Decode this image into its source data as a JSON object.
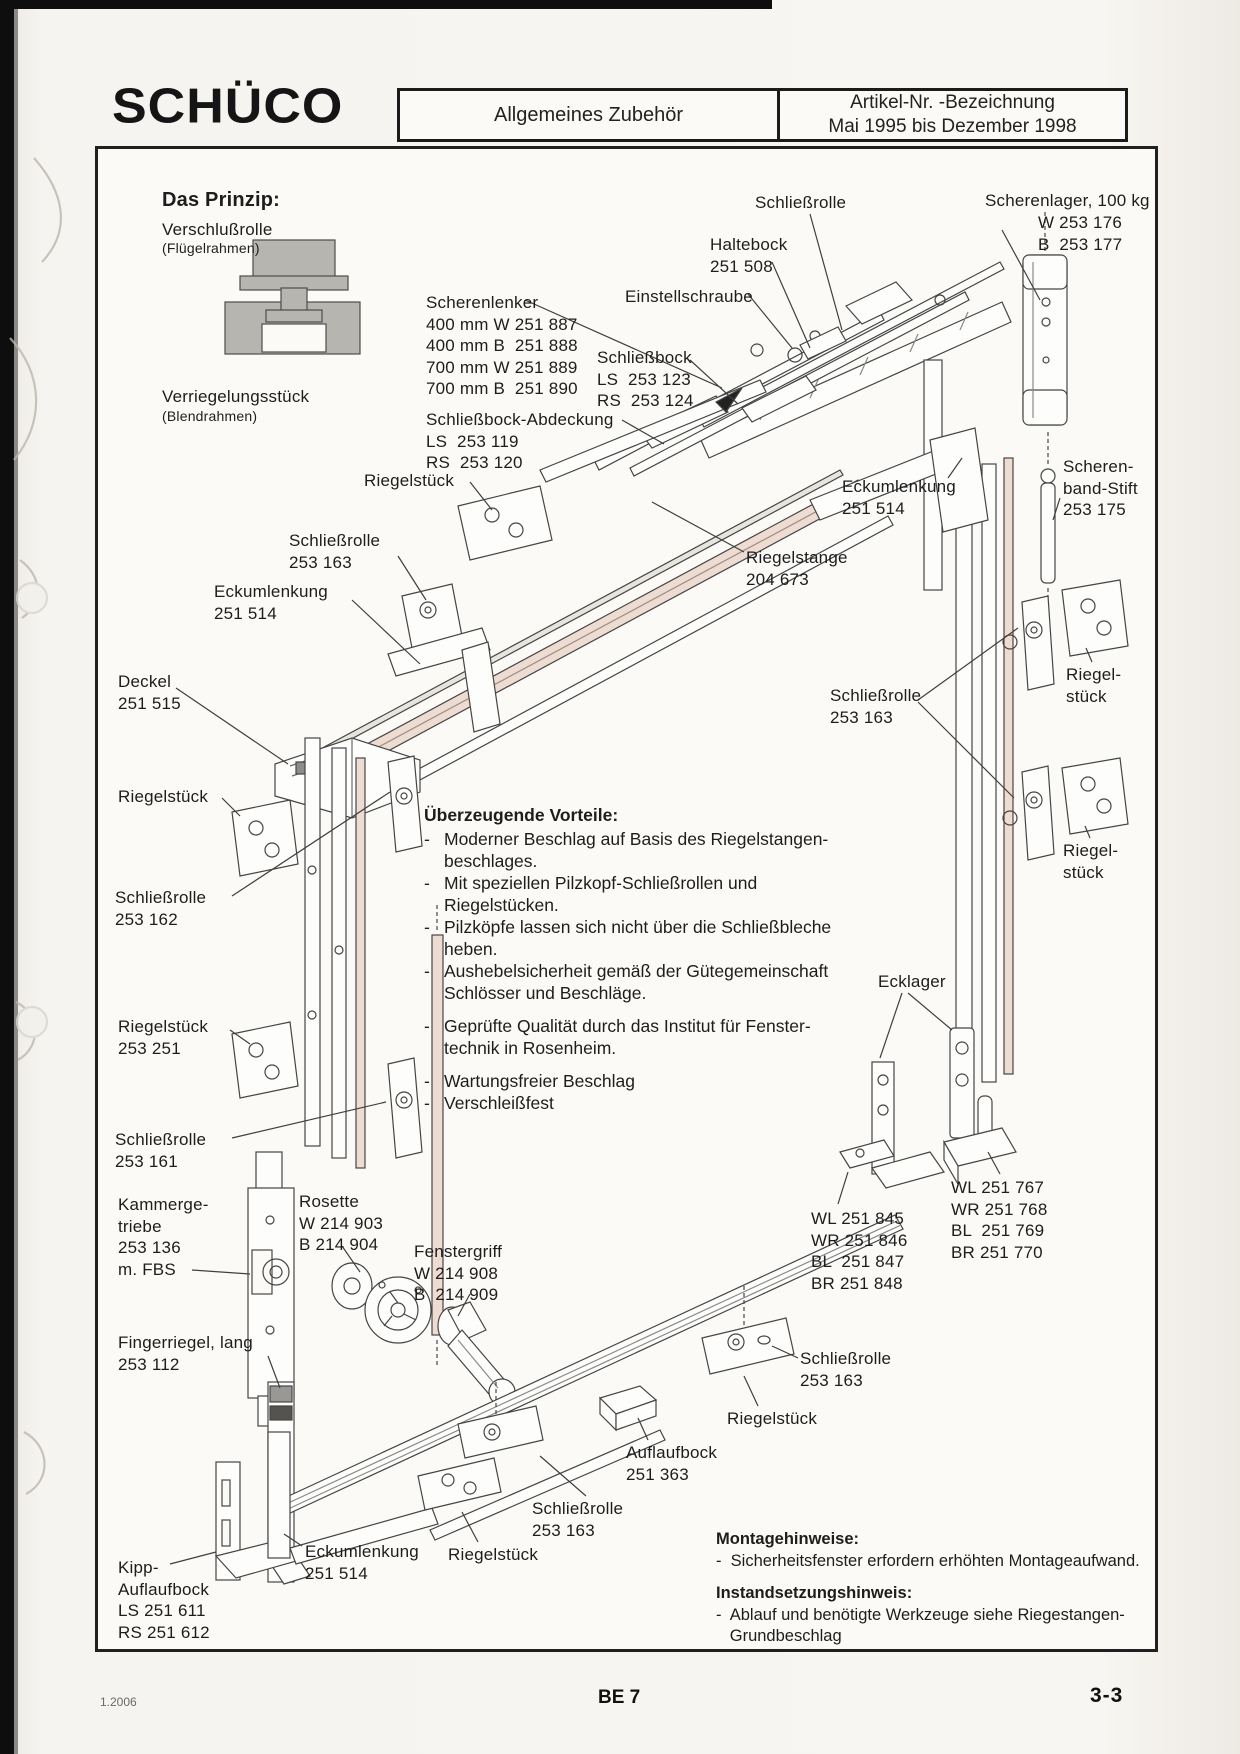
{
  "header": {
    "logo": "SCHÜCO",
    "section": "Allgemeines Zubehör",
    "right_line1": "Artikel-Nr. -Bezeichnung",
    "right_line2": "Mai 1995 bis Dezember 1998"
  },
  "advantages": {
    "title": "Überzeugende Vorteile:",
    "lines": [
      {
        "dash": true,
        "text": "Moderner Beschlag auf Basis des Riegelstangen-"
      },
      {
        "dash": false,
        "text": "beschlages."
      },
      {
        "dash": true,
        "text": "Mit speziellen Pilzkopf-Schließrollen und"
      },
      {
        "dash": false,
        "text": "Riegelstücken."
      },
      {
        "dash": true,
        "text": "Pilzköpfe lassen sich nicht über die Schließbleche"
      },
      {
        "dash": false,
        "text": "heben."
      },
      {
        "dash": true,
        "text": "Aushebelsicherheit gemäß der Gütegemeinschaft"
      },
      {
        "dash": false,
        "text": "Schlösser und Beschläge."
      },
      {
        "gap": true
      },
      {
        "dash": true,
        "text": "Geprüfte Qualität  durch das Institut für Fenster-"
      },
      {
        "dash": false,
        "text": "technik in Rosenheim."
      },
      {
        "gap": true
      },
      {
        "dash": true,
        "text": "Wartungsfreier Beschlag"
      },
      {
        "dash": true,
        "text": "Verschleißfest"
      }
    ]
  },
  "notes": [
    {
      "title": "Montagehinweise:",
      "lines": [
        "-  Sicherheitsfenster erfordern erhöhten Montageaufwand."
      ]
    },
    {
      "title": "Instandsetzungshinweis:",
      "lines": [
        "-  Ablauf und benötigte Werkzeuge siehe Riegestangen-",
        "   Grundbeschlag"
      ]
    }
  ],
  "labels": [
    {
      "id": "das-prinzip-title",
      "x": 162,
      "y": 188,
      "bold": true,
      "size": 20,
      "lines": [
        "Das Prinzip:"
      ]
    },
    {
      "id": "verschlussrolle-label",
      "x": 162,
      "y": 219,
      "lines": [
        "Verschlußrolle"
      ]
    },
    {
      "id": "verschlussrolle-sub",
      "x": 162,
      "y": 240,
      "size": 14,
      "lines": [
        "(Flügelrahmen)"
      ]
    },
    {
      "id": "verriegelungsstueck-label",
      "x": 162,
      "y": 386,
      "lines": [
        "Verriegelungsstück"
      ]
    },
    {
      "id": "verriegelungsstueck-sub",
      "x": 162,
      "y": 408,
      "size": 14,
      "lines": [
        "(Blendrahmen)"
      ]
    },
    {
      "id": "label-schliessrolle-top",
      "x": 755,
      "y": 192,
      "lines": [
        "Schließrolle"
      ]
    },
    {
      "id": "label-haltebock",
      "x": 710,
      "y": 234,
      "lines": [
        "Haltebock",
        "251 508"
      ]
    },
    {
      "id": "label-scherenlager",
      "x": 985,
      "y": 190,
      "lines": [
        "Scherenlager, 100 kg"
      ]
    },
    {
      "id": "label-scherenlager-nums",
      "x": 1038,
      "y": 212,
      "lines": [
        "W 253 176",
        "B  253 177"
      ]
    },
    {
      "id": "label-scherenlenker",
      "x": 426,
      "y": 292,
      "lines": [
        "Scherenlenker",
        "400 mm W 251 887",
        "400 mm B  251 888",
        "700 mm W 251 889",
        "700 mm B  251 890"
      ]
    },
    {
      "id": "label-einstellschraube",
      "x": 625,
      "y": 286,
      "lines": [
        "Einstellschraube"
      ]
    },
    {
      "id": "label-schliessbock",
      "x": 597,
      "y": 347,
      "lines": [
        "Schließbock",
        "LS  253 123",
        "RS  253 124"
      ]
    },
    {
      "id": "label-schliessbock-abdeckung",
      "x": 426,
      "y": 409,
      "lines": [
        "Schließbock-Abdeckung",
        "LS  253 119",
        "RS  253 120"
      ]
    },
    {
      "id": "label-riegelstueck-top",
      "x": 364,
      "y": 470,
      "lines": [
        "Riegelstück"
      ]
    },
    {
      "id": "label-scherenband-stift",
      "x": 1063,
      "y": 456,
      "lines": [
        "Scheren-",
        "band-Stift",
        "253 175"
      ]
    },
    {
      "id": "label-eckumlenkung-right",
      "x": 842,
      "y": 476,
      "lines": [
        "Eckumlenkung",
        "251 514"
      ]
    },
    {
      "id": "label-schliessrolle-163-left",
      "x": 289,
      "y": 530,
      "lines": [
        "Schließrolle",
        "253 163"
      ]
    },
    {
      "id": "label-riegelstange",
      "x": 746,
      "y": 547,
      "lines": [
        "Riegelstange",
        "204 673"
      ]
    },
    {
      "id": "label-eckumlenkung-left",
      "x": 214,
      "y": 581,
      "lines": [
        "Eckumlenkung",
        "251 514"
      ]
    },
    {
      "id": "label-deckel",
      "x": 118,
      "y": 671,
      "lines": [
        "Deckel",
        "251 515"
      ]
    },
    {
      "id": "label-schliessrolle-163-right",
      "x": 830,
      "y": 685,
      "lines": [
        "Schließrolle",
        "253 163"
      ]
    },
    {
      "id": "label-riegelstueck-right-1",
      "x": 1066,
      "y": 664,
      "lines": [
        "Riegel-",
        "stück"
      ]
    },
    {
      "id": "label-riegelstueck-left-1",
      "x": 118,
      "y": 786,
      "lines": [
        "Riegelstück"
      ]
    },
    {
      "id": "label-riegelstueck-right-2",
      "x": 1063,
      "y": 840,
      "lines": [
        "Riegel-",
        "stück"
      ]
    },
    {
      "id": "label-schliessrolle-162",
      "x": 115,
      "y": 887,
      "lines": [
        "Schließrolle",
        "253 162"
      ]
    },
    {
      "id": "label-ecklager",
      "x": 878,
      "y": 971,
      "lines": [
        "Ecklager"
      ]
    },
    {
      "id": "label-riegelstueck-253-251",
      "x": 118,
      "y": 1016,
      "lines": [
        "Riegelstück",
        "253 251"
      ]
    },
    {
      "id": "label-schliessrolle-161",
      "x": 115,
      "y": 1129,
      "lines": [
        "Schließrolle",
        "253 161"
      ]
    },
    {
      "id": "label-kammergetriebe",
      "x": 118,
      "y": 1194,
      "lines": [
        "Kammerge-",
        "triebe",
        "253 136",
        "m. FBS"
      ]
    },
    {
      "id": "label-rosette",
      "x": 299,
      "y": 1191,
      "lines": [
        "Rosette",
        "W 214 903",
        "B 214 904"
      ]
    },
    {
      "id": "label-ecklager-nums-right",
      "x": 951,
      "y": 1177,
      "lines": [
        "WL 251 767",
        "WR 251 768",
        "BL  251 769",
        "BR 251 770"
      ]
    },
    {
      "id": "label-ecklager-nums-left",
      "x": 811,
      "y": 1208,
      "lines": [
        "WL 251 845",
        "WR 251 846",
        "BL  251 847",
        "BR 251 848"
      ]
    },
    {
      "id": "label-fenstergriff",
      "x": 414,
      "y": 1241,
      "lines": [
        "Fenstergriff",
        "W 214 908",
        "B  214 909"
      ]
    },
    {
      "id": "label-fingerriegel",
      "x": 118,
      "y": 1332,
      "lines": [
        "Fingerriegel, lang",
        "253 112"
      ]
    },
    {
      "id": "label-schliessrolle-163-b1",
      "x": 800,
      "y": 1348,
      "lines": [
        "Schließrolle",
        "253 163"
      ]
    },
    {
      "id": "label-riegelstueck-b1",
      "x": 727,
      "y": 1408,
      "lines": [
        "Riegelstück"
      ]
    },
    {
      "id": "label-auflaufbock",
      "x": 626,
      "y": 1442,
      "lines": [
        "Auflaufbock",
        "251 363"
      ]
    },
    {
      "id": "label-schliessrolle-163-b2",
      "x": 532,
      "y": 1498,
      "lines": [
        "Schließrolle",
        "253 163"
      ]
    },
    {
      "id": "label-eckumlenkung-bottom",
      "x": 305,
      "y": 1541,
      "lines": [
        "Eckumlenkung",
        "251 514"
      ]
    },
    {
      "id": "label-riegelstueck-b2",
      "x": 448,
      "y": 1544,
      "lines": [
        "Riegelstück"
      ]
    },
    {
      "id": "label-kipp-auflaufbock",
      "x": 118,
      "y": 1557,
      "lines": [
        "Kipp-",
        "Auflaufbock",
        "LS 251 611",
        "RS 251 612"
      ]
    }
  ],
  "footer": {
    "edition": "1.2006",
    "page_code": "BE 7",
    "page_number": "3-3"
  }
}
